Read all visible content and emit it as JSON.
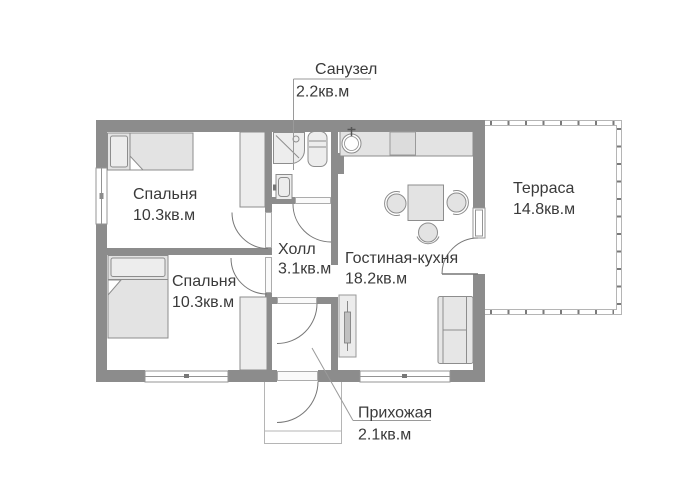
{
  "plan": {
    "rooms": [
      {
        "id": "bathroom",
        "name": "Санузел",
        "area": "2.2кв.м"
      },
      {
        "id": "bedroom-top",
        "name": "Спальня",
        "area": "10.3кв.м"
      },
      {
        "id": "bedroom-bottom",
        "name": "Спальня",
        "area": "10.3кв.м"
      },
      {
        "id": "hall",
        "name": "Холл",
        "area": "3.1кв.м"
      },
      {
        "id": "living-kitchen",
        "name": "Гостиная-кухня",
        "area": "18.2кв.м"
      },
      {
        "id": "terrace",
        "name": "Терраса",
        "area": "14.8кв.м"
      },
      {
        "id": "entry",
        "name": "Прихожая",
        "area": "2.1кв.м"
      }
    ],
    "symbols": [
      "double-bed-symbol",
      "single-bed-symbol",
      "wardrobe-symbol",
      "shower-cabin-symbol",
      "toilet-symbol",
      "washbasin-symbol",
      "kitchen-counter-symbol",
      "kitchen-sink-symbol",
      "stove-symbol",
      "dining-table-symbol",
      "chair-symbol",
      "sofa-symbol",
      "tall-cabinet-symbol",
      "door-swing-symbol",
      "window-symbol",
      "terrace-railing-symbol",
      "porch-symbol"
    ],
    "colors": {
      "background": "#ffffff",
      "wall": "#8c8c8c",
      "furniture_fill": "#e3e3e3",
      "outline": "#8d8d8d",
      "railing": "#b5b5b5",
      "text": "#3a3a3a",
      "leader": "#9a9a9a"
    }
  }
}
